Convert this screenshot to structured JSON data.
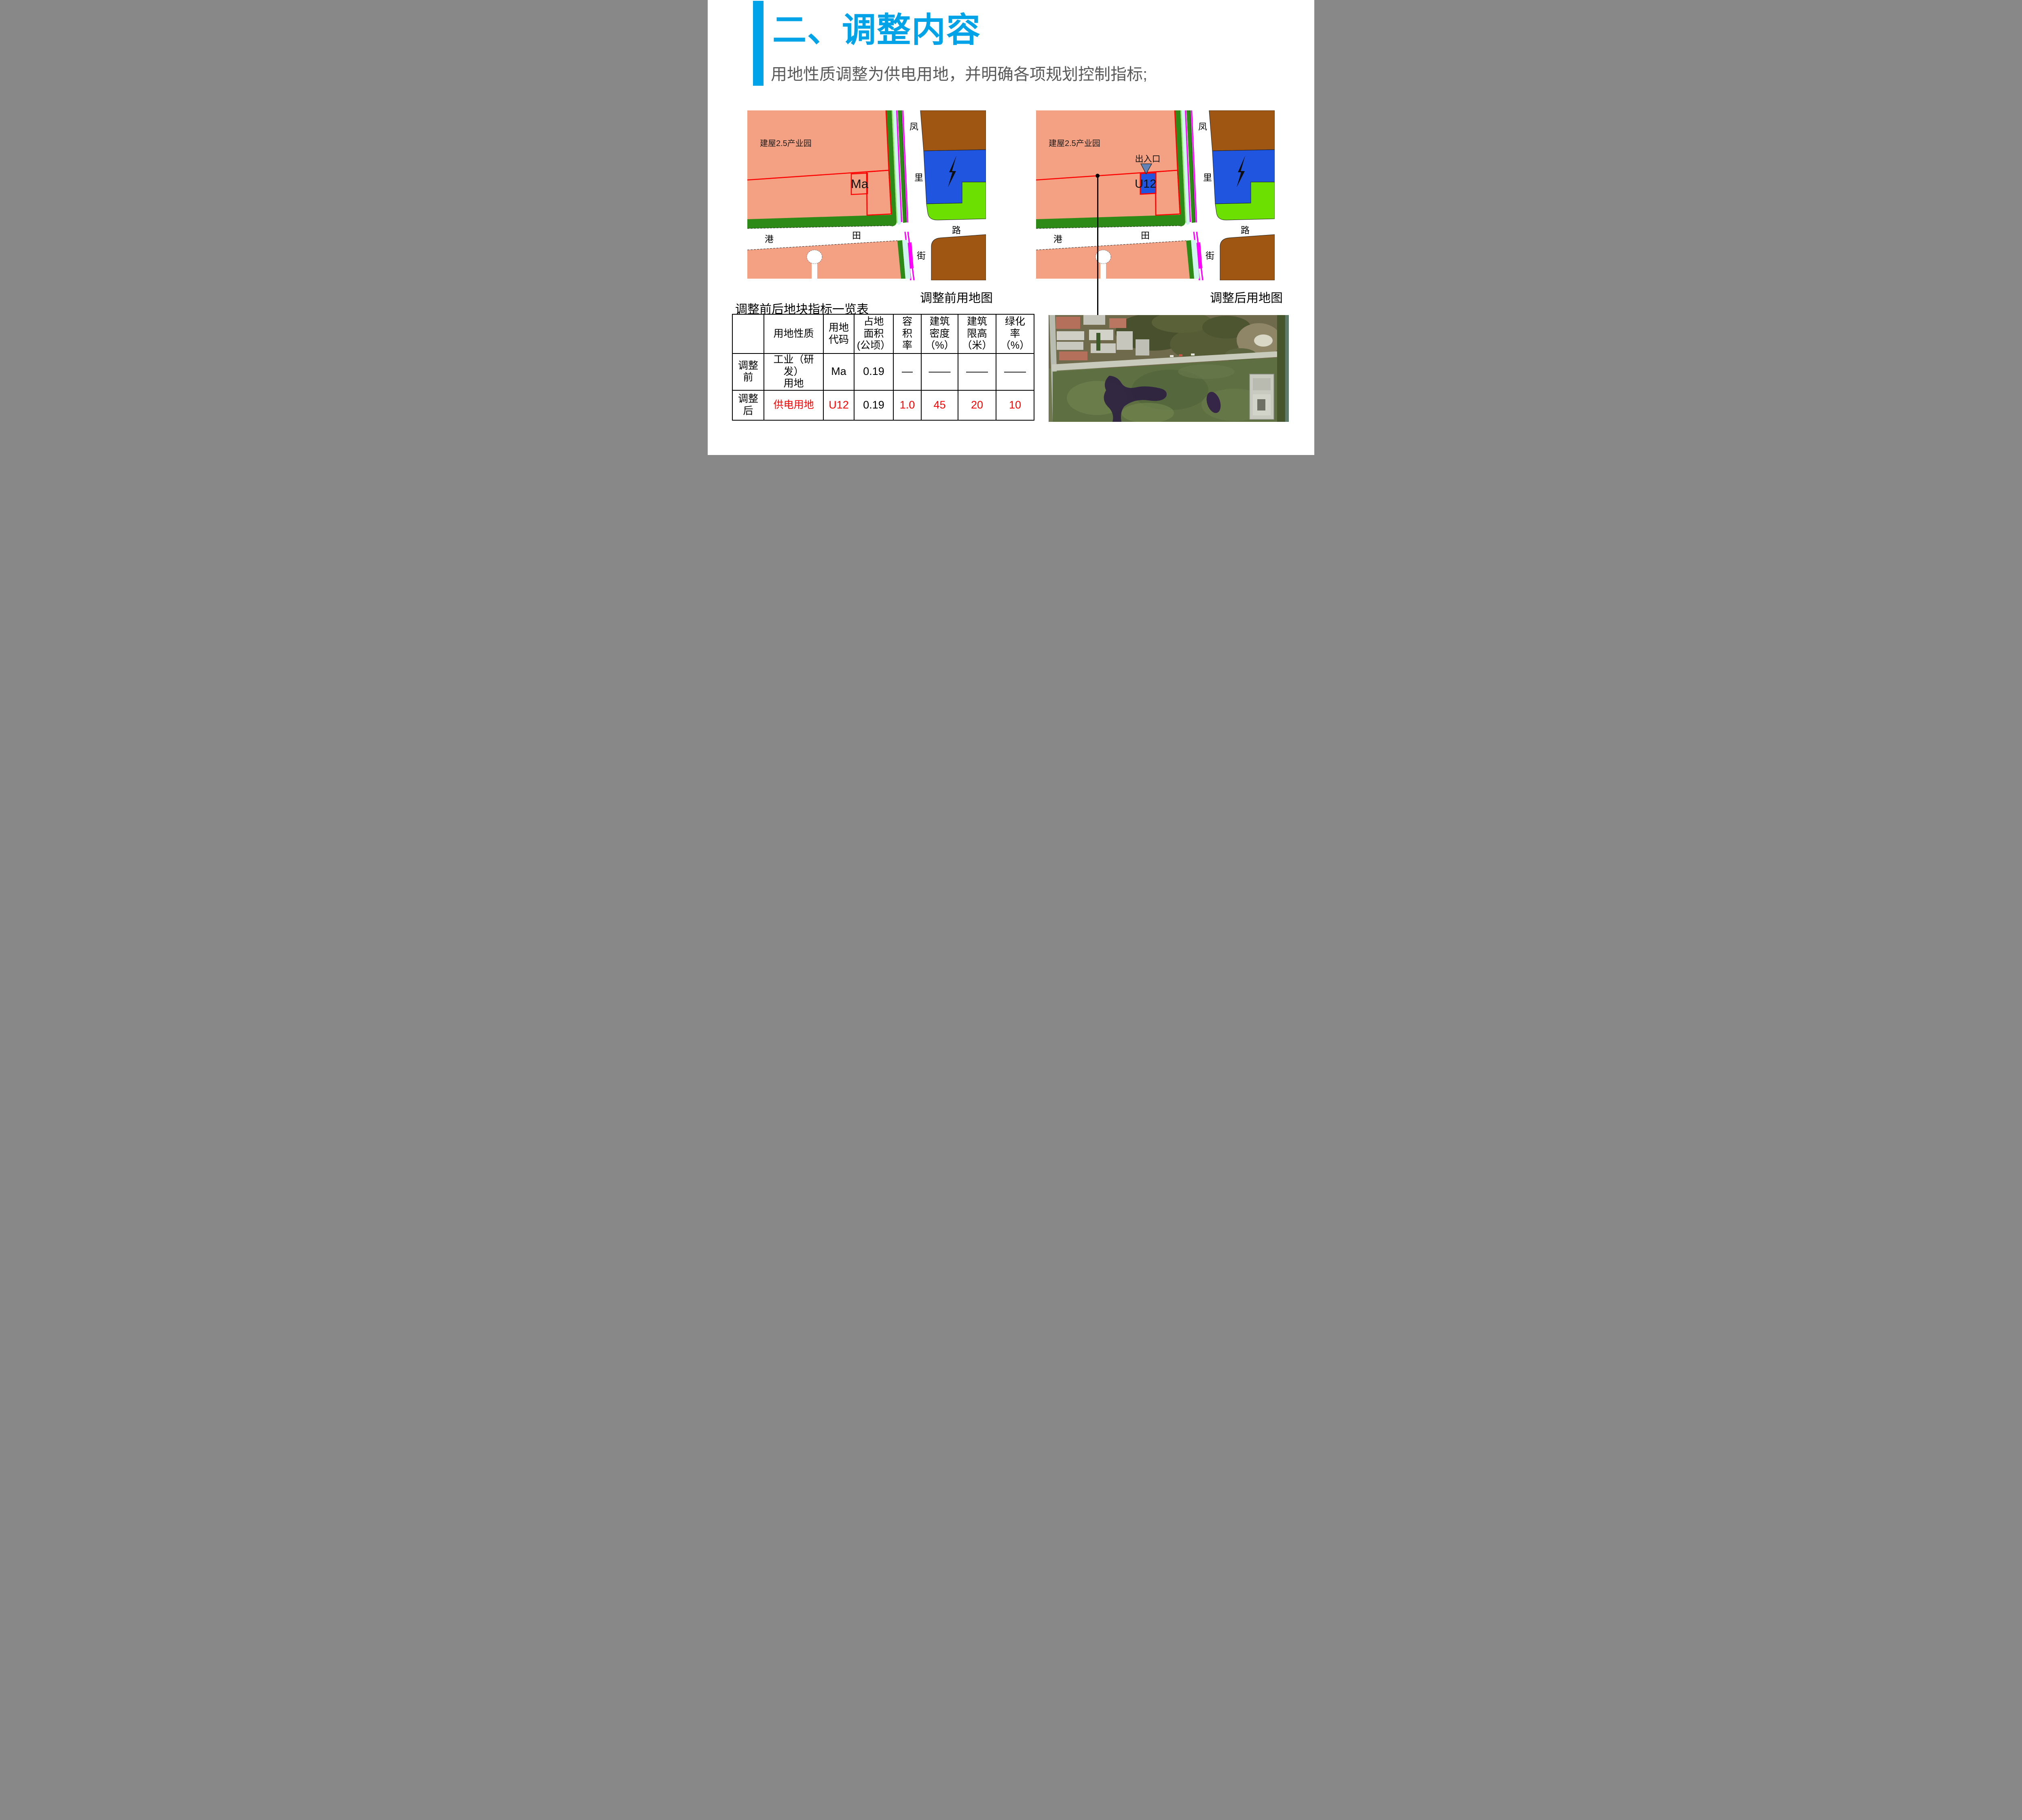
{
  "header": {
    "title": "二、调整内容",
    "subtitle": "用地性质调整为供电用地，并明确各项规划控制指标;"
  },
  "maps": {
    "parcel_label": "建屋2.5产业园",
    "road_labels": {
      "feng": "凤",
      "li": "里",
      "jie": "街",
      "gang": "港",
      "tian": "田",
      "lu": "路"
    },
    "before": {
      "caption": "调整前用地图",
      "plot_code": "Ma"
    },
    "after": {
      "caption": "调整后用地图",
      "plot_code": "U12",
      "entrance_label": "出入口"
    }
  },
  "table": {
    "title": "调整前后地块指标一览表",
    "headers": [
      "",
      "用地性质",
      "用地\n代码",
      "占地\n面积\n(公顷）",
      "容\n积\n率",
      "建筑\n密度\n（%）",
      "建筑\n限高\n（米）",
      "绿化\n率\n（%）"
    ],
    "rows": [
      {
        "label": "调整\n前",
        "cells": [
          "工业（研发）\n用地",
          "Ma",
          "0.19",
          "—",
          "——",
          "——",
          "——"
        ]
      },
      {
        "label": "调整\n后",
        "cells": [
          "供电用地",
          "U12",
          "0.19",
          "1.0",
          "45",
          "20",
          "10"
        ]
      }
    ]
  },
  "colors": {
    "accent_blue": "#00A3E8",
    "subtitle_gray": "#595959",
    "highlight_red": "#FF0000",
    "industrial_salmon": "#F4A083",
    "utility_blue": "#1F55DF",
    "greenbelt_dark_green": "#2E8A16",
    "park_bright_green": "#6CE000",
    "village_brown": "#9E5612",
    "waterside_cyan": "#CFF5EF",
    "road_line_magenta": "#FF00FF"
  }
}
